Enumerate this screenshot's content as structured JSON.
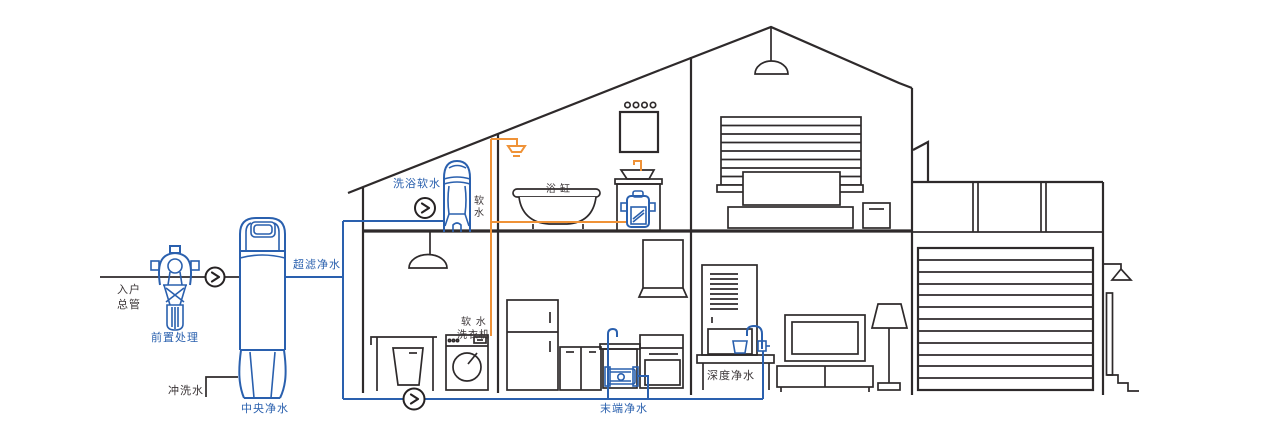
{
  "diagram": {
    "supply": {
      "entry_label_line1": "入户",
      "entry_label_line2": "总管",
      "pre_filter_label": "前置处理",
      "flush_water_label": "冲洗水",
      "central_purifier_label": "中央净水",
      "ultrafiltration_label": "超滤净水"
    },
    "second_floor": {
      "shower_softener_label": "洗浴软水",
      "soft_water_pipe_char1": "软",
      "soft_water_pipe_char2": "水",
      "bathtub_label": "浴缸"
    },
    "first_floor": {
      "washer_label_line1": "软 水",
      "washer_label_line2": "洗衣机",
      "terminal_purifier_label": "末端净水",
      "deep_purifier_label": "深度净水"
    }
  },
  "colors": {
    "device_blue": "#2a60ae",
    "pipe_orange": "#ef9237",
    "line_dark": "#2e2a2b",
    "background": "#ffffff"
  },
  "icons": {
    "valve": "circle-with-right-chevron flow valve"
  }
}
